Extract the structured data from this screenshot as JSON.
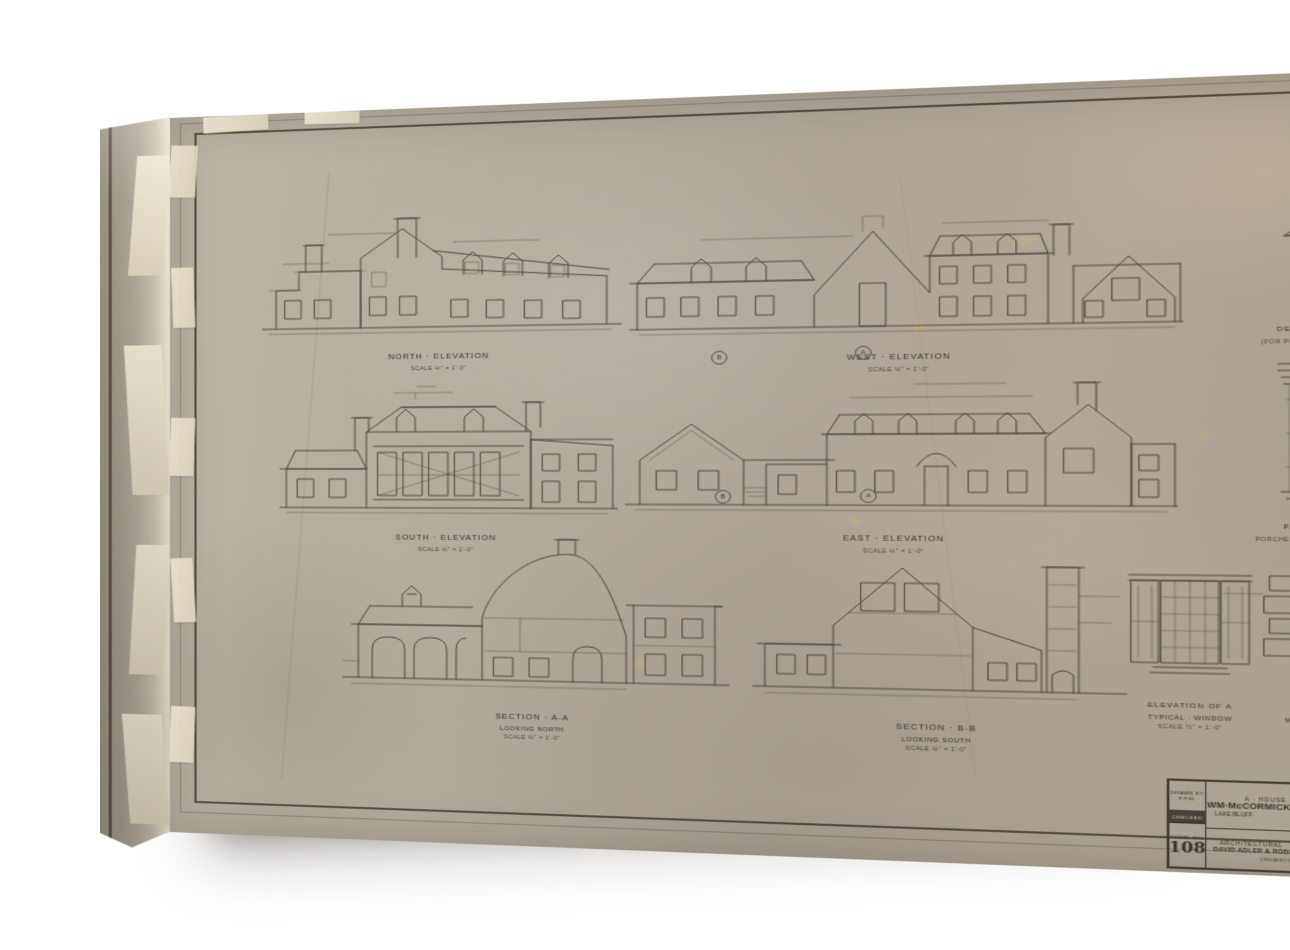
{
  "colors": {
    "background": "#ffffff",
    "paper": "#b3ab9d",
    "ink": "#453f33",
    "tape": "#ece4d0"
  },
  "sheet": {
    "figures": [
      {
        "label": "NORTH · ELEVATION",
        "note": "",
        "scale": "SCALE ⅛\" = 1'-0\""
      },
      {
        "label": "WEST · ELEVATION",
        "note": "",
        "scale": "SCALE ⅛\" = 1'-0\""
      },
      {
        "label": "DETAIL of A DORMER",
        "note": "(FOR POSITIONS SEE ELEVATIONS)",
        "scale": "SCALE ½\" = 1'-0\""
      },
      {
        "label": "SOUTH · ELEVATION",
        "note": "",
        "scale": "SCALE ⅛\" = 1'-0\""
      },
      {
        "label": "EAST · ELEVATION",
        "note": "",
        "scale": "SCALE ⅛\" = 1'-0\""
      },
      {
        "label": "PART ELEVATION OF",
        "note": "PORCHES ON EAST & WEST ELEVATIONS",
        "scale": "SCALE ½\" = 1'-0\""
      },
      {
        "label": "SECTION · A-A",
        "note": "LOOKING NORTH",
        "scale": "SCALE ⅛\" = 1'-0\""
      },
      {
        "label": "SECTION · B-B",
        "note": "LOOKING SOUTH",
        "scale": "SCALE ⅛\" = 1'-0\""
      },
      {
        "label": "ELEVATION OF A",
        "note": "TYPICAL · WINDOW",
        "scale": "SCALE ½\" = 1'-0\""
      },
      {
        "label": "ELEVATION OF",
        "note": "MAIN · ENTRANCE · DOORWAY",
        "scale": "SCALE ¾\" = 1'-0\""
      }
    ],
    "section_markers": {
      "left": "B",
      "right": "A"
    },
    "title_block": {
      "project_line1": "A · HOUSE · FOR",
      "project_line2": "WM·McCORMICK·BLAIR·ESQ",
      "location_left": "LAKE·BLUFF",
      "location_right": "ILLINOIS",
      "firm_line1": "ARCHITECTURAL · OFFICE · OF",
      "firm_line2": "DAVID ADLER & ROBERT WORK INC",
      "firm_line3": "CHICAGO ILL.",
      "drawn_by_label": "DRAWN BY",
      "drawn_by": "F.P.M.",
      "checked_label": "CHECKED",
      "comm_label": "COMM. NO.",
      "comm_no": "108",
      "date_label": "DATE",
      "revised_label": "REVISED",
      "sheet_label": "SHEET NO.",
      "sheet_no": "5"
    }
  }
}
